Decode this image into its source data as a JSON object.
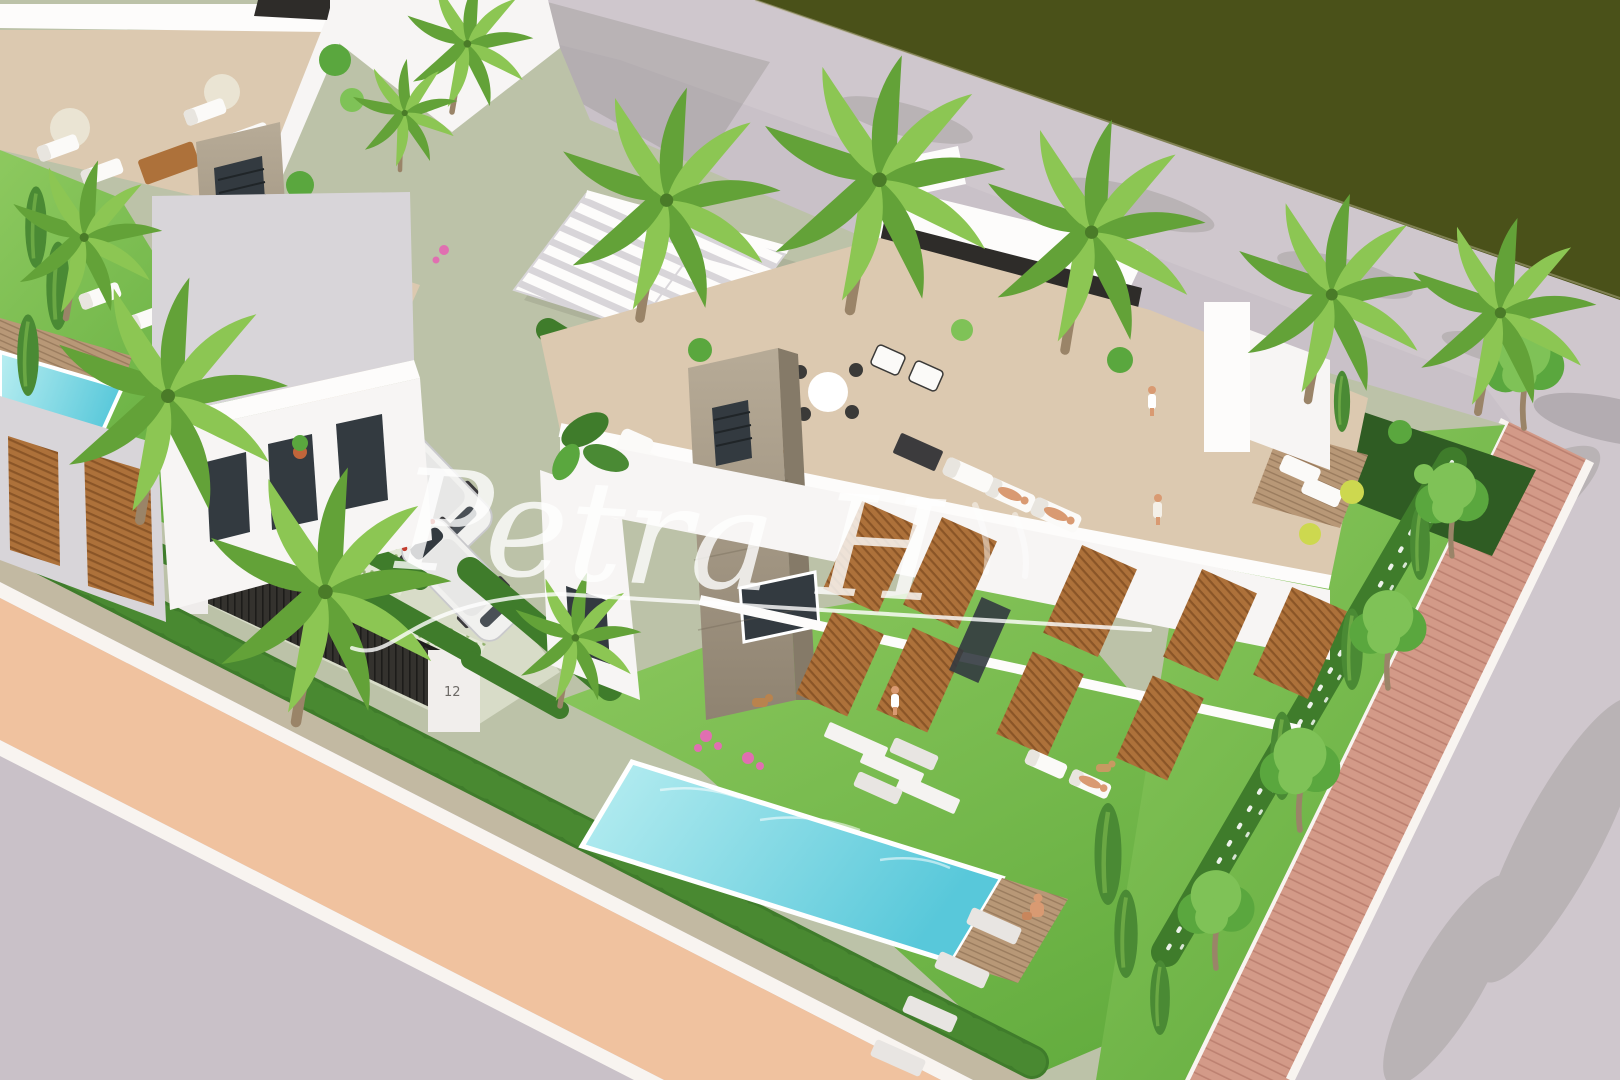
{
  "meta": {
    "description": "Aerial 3D architectural render of modern white villas with rooftop terraces, gardens, swimming pools, palm trees, a driveway with cars, pedestrian paths and a green canal strip"
  },
  "watermark": {
    "text": "Petra H",
    "color": "#ffffff",
    "opacity": 0.8
  },
  "labels": {
    "gate_house_number": "12"
  },
  "palette": {
    "canal_green": "#4a5119",
    "sidewalk": "#cfc7cd",
    "road": "#c9c1c8",
    "salmon_path": "#f0c29f",
    "curb_white": "#f8f4f0",
    "gravel": "#c2b9a2",
    "brick_path": "#d39a88",
    "brick_joint": "#bd8171",
    "grass_light": "#8dc95f",
    "grass": "#64ad3f",
    "hedge": "#3f7c2b",
    "hedge_dark": "#2f5c23",
    "cypress": "#4a8a34",
    "canopy": "#5aa73e",
    "canopy_light": "#7fc257",
    "palm": "#63a238",
    "palm_light": "#8cc653",
    "trunk": "#9a8468",
    "building_white": "#f7f5f4",
    "building_sun": "#fdfcfb",
    "building_shade": "#d8d5d9",
    "building_dark": "#c6c3ca",
    "black_trim": "#2e2c29",
    "glass_dark": "#333a40",
    "stone": "#b7ab97",
    "stone_dark": "#8f8371",
    "wood": "#ad713a",
    "wood_dark": "#8a5527",
    "deck_wood": "#b89877",
    "terrace_floor": "#dcc9b0",
    "pool_light": "#b9eef1",
    "pool_deep": "#58c8da",
    "lounger_white": "#fbfaf8",
    "skin": "#d99a72",
    "lime_pouf": "#cdd84f",
    "flower_pink": "#e06fb1",
    "fence_dark": "#34322e",
    "car_white": "#f1f1ef"
  },
  "scene": {
    "objects": [
      "white modern villas with flat roofs and black parapet trim",
      "two stone chimney towers with vent grilles",
      "slatted white pergola roof",
      "rooftop terraces with sofas, dining set, loungers and people",
      "main garden swimming pool with wooden deck",
      "neighbor garden pool with loungers",
      "driveway with two white cars and patterned tiles",
      "black entrance fence with white gate pillars",
      "tall palm trees along the street",
      "row of round street trees on a red brick path",
      "cypress trees and flowering hedges",
      "salmon pedestrian path with white curbs",
      "gray road and sidewalk with cast shadows",
      "dark green canal strip",
      "people sunbathing and walking, two dogs",
      "white script watermark signature"
    ]
  }
}
